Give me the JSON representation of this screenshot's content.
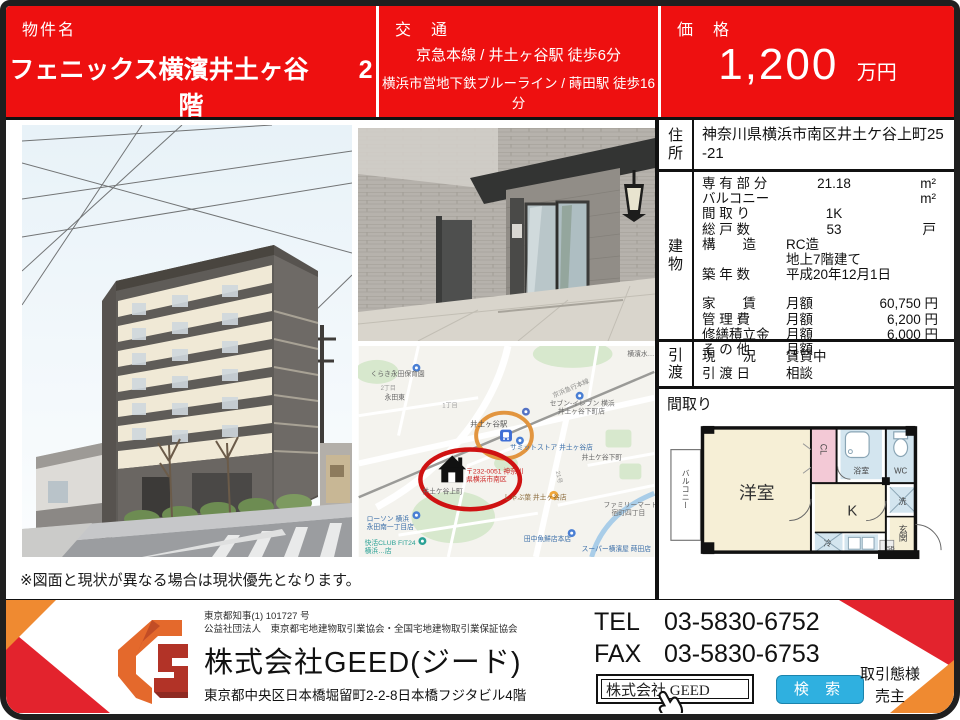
{
  "header": {
    "property_label": "物件名",
    "property_name": "フェニックス横濱井土ヶ谷　　2階",
    "transport_label": "交　通",
    "transport_line1": "京急本線 / 井土ヶ谷駅 徒歩6分",
    "transport_line2": "横浜市営地下鉄ブルーライン / 蒔田駅 徒歩16分",
    "price_label": "価　格",
    "price_value": "1,200",
    "price_unit": "万円"
  },
  "info": {
    "address_label": "住所",
    "address_value": "神奈川県横浜市南区井土ケ谷上町25-21",
    "building_label": "建物",
    "spec_rows": [
      {
        "name": "専 有 部 分",
        "value": "21.18",
        "unit": "m²"
      },
      {
        "name": "バルコニー",
        "value": "",
        "unit": "m²"
      },
      {
        "name": "間 取 り",
        "value": "1K",
        "unit": ""
      },
      {
        "name": "総 戸 数",
        "value": "53",
        "unit": "戸"
      },
      {
        "name": "構　　造",
        "value": "RC造",
        "unit": ""
      },
      {
        "name": "",
        "value": "地上7階建て",
        "unit": ""
      },
      {
        "name": "築 年 数",
        "value": "平成20年12月1日",
        "unit": ""
      }
    ],
    "fee_rows": [
      {
        "name": "家　　賃",
        "period": "月額",
        "amount": "60,750 円"
      },
      {
        "name": "管 理 費",
        "period": "月額",
        "amount": "6,200 円"
      },
      {
        "name": "修繕積立金",
        "period": "月額",
        "amount": "6,000 円"
      },
      {
        "name": "そ の 他",
        "period": "月額",
        "amount": ""
      }
    ],
    "handover_label": "引渡",
    "handover_rows": [
      {
        "name": "現　　況",
        "value": "賃貸中"
      },
      {
        "name": "引 渡 日",
        "value": "相談"
      }
    ],
    "plan_label": "間取り"
  },
  "floorplan": {
    "balcony": "バルコニー",
    "room": "洋室",
    "cl": "CL",
    "bath": "浴室",
    "wc": "WC",
    "wash": "洗",
    "kitchen": "K",
    "entrance": "玄関",
    "fridge": "冷",
    "sb": "SB"
  },
  "map": {
    "station_label": "井土ヶ谷駅",
    "railway_label": "京浜急行本線",
    "route_label": "21号",
    "nursery": "くらき永田保育園",
    "district1": "永田東",
    "chome2": "2丁目",
    "chome1": "1丁目",
    "seven_line1": "セブン-イレブン 横浜",
    "seven_line2": "井土ヶ谷下町店",
    "summit": "サミットストア 井土ヶ谷店",
    "shimomachi": "井土ケ谷下町",
    "kamimachi": "井土ケ谷上町",
    "postal_line1": "〒232-0051 神奈川",
    "postal_line2": "県横浜市南区",
    "shabu": "しゃぶ葉 井土ヶ谷店",
    "lawson_line1": "ローソン 横浜",
    "lawson_line2": "永田南一丁目店",
    "kaikatsu_line1": "快活CLUB FIT24",
    "kaikatsu_line2": "横浜…店",
    "tanaka": "田中魚鮮店本店",
    "super_market": "スーパー横濱屋 蒔田店",
    "famima_line1": "ファミリーマート",
    "famima_line2": "宿町四丁目",
    "water_label": "横濱水…"
  },
  "disclaimer": "※図面と現状が異なる場合は現状優先となります。",
  "footer": {
    "license_line1": "東京都知事(1) 101727 号",
    "license_line2": "公益社団法人　東京都宅地建物取引業協会・全国宅地建物取引業保証協会",
    "company_name": "株式会社GEED(ジード)",
    "company_address": "東京都中央区日本橋堀留町2-2-8日本橋フジタビル4階",
    "tel_label": "TEL",
    "tel_number": "03-5830-6752",
    "fax_label": "FAX",
    "fax_number": "03-5830-6753",
    "search_value": "株式会社 GEED",
    "search_button": "検 索",
    "dealing_label": "取引態様",
    "dealing_value": "売主"
  },
  "colors": {
    "header_red": "#ee1010",
    "accent_red": "#e3232d",
    "accent_orange": "#ef8a31",
    "search_blue": "#2fb0e0",
    "map_circle_orange": "#e2953f",
    "map_circle_red": "#cf1212"
  }
}
